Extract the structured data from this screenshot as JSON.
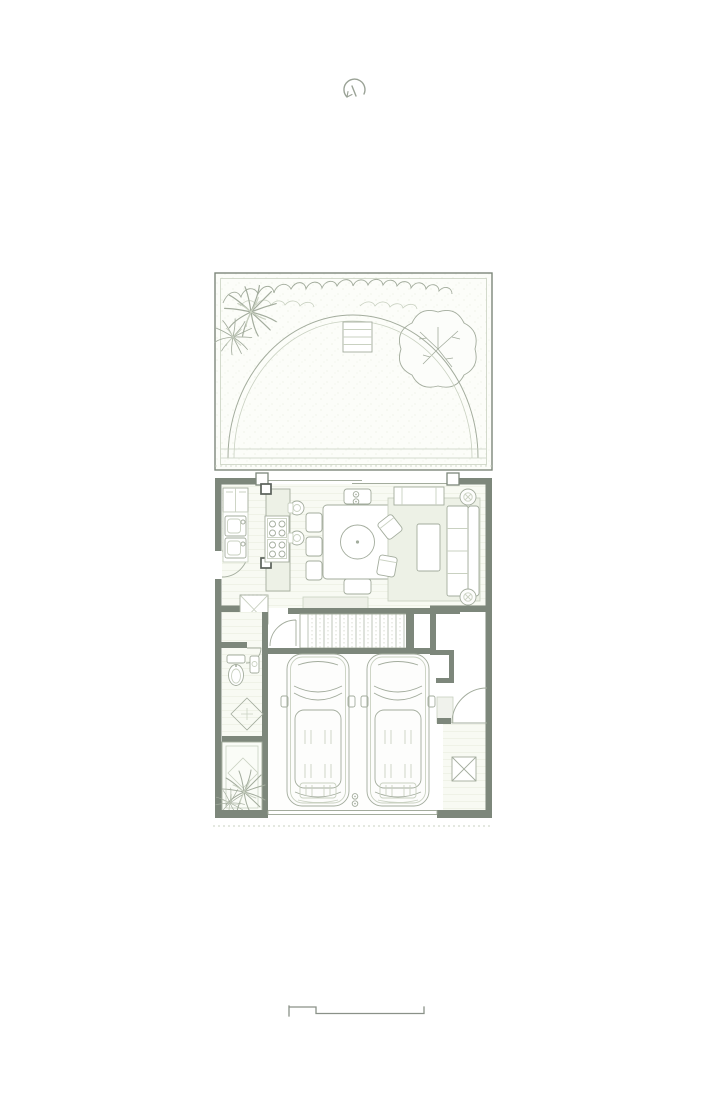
{
  "page": {
    "background": "#ffffff",
    "kind": "architectural-floor-plan-sheet"
  },
  "colors": {
    "wall": "#7d877b",
    "line": "#a3ac9d",
    "faint": "#c9d1c1",
    "dark": "#5a615a",
    "room": "#f8faf3",
    "accent": "#edf1e6",
    "tint": "#fbfcf8",
    "white": "#fdfdfc",
    "bg": "#ffffff"
  },
  "plan": {
    "areas": [
      "garden",
      "kitchen",
      "dining",
      "living-room",
      "staircase",
      "bathroom",
      "hallway",
      "garage",
      "entry",
      "planter"
    ],
    "garden_elements": [
      "hedge-row",
      "palm-tree",
      "palm-tree",
      "deciduous-tree",
      "lawn-arc",
      "garden-steps",
      "terrace-edge"
    ],
    "kitchen_elements": [
      "refrigerator",
      "counter",
      "double-sink",
      "island",
      "cooktop",
      "round-basins",
      "column",
      "column"
    ],
    "dining_elements": [
      "dining-table",
      "center-bowl",
      "chairs-x8",
      "pendant-light"
    ],
    "living_elements": [
      "rug",
      "console",
      "sofa",
      "coffee-table",
      "armchair",
      "armchair",
      "potted-plant",
      "potted-plant",
      "hearth-platform",
      "closet-x"
    ],
    "garage_elements": [
      "car",
      "car",
      "ceiling-light",
      "niche-wall",
      "shelf",
      "entry-door",
      "x-box",
      "threshold"
    ],
    "bath_elements": [
      "toilet",
      "wash-basin",
      "door"
    ],
    "symbols": {
      "north_arrow": true,
      "scale_bar": true,
      "property_line": "dashed",
      "floor_diamond_tiles": 2
    },
    "counts": {
      "cars": 2,
      "dining_chairs": 8,
      "palm_trees": 4
    }
  }
}
